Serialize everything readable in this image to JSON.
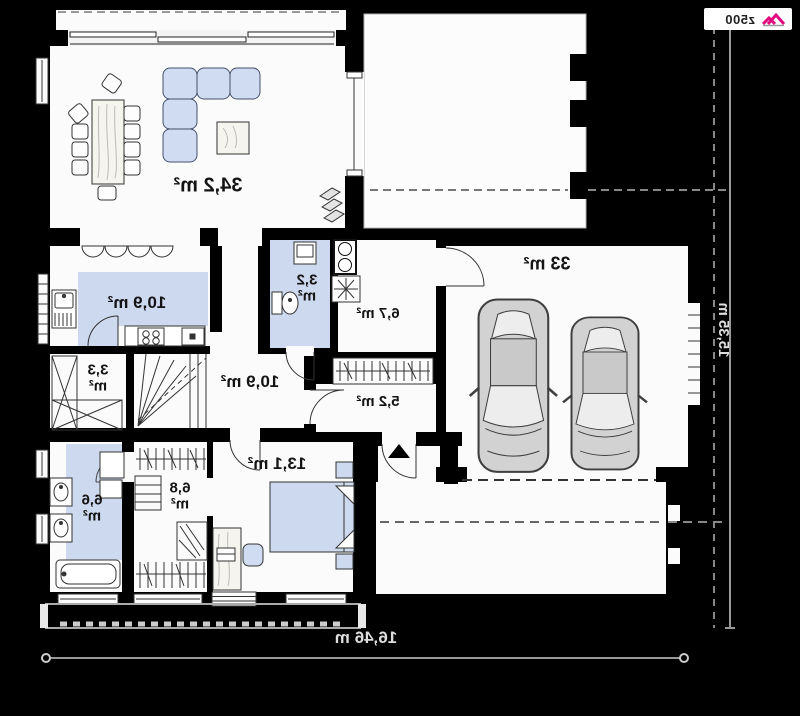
{
  "plan": {
    "rooms": {
      "living_room": "34,2 m²",
      "kitchen": "10,9 m²",
      "pantry": "3,3 m²",
      "bathroom": "6,6 m²",
      "wardrobe": "6,8 m²",
      "bedroom": "13,1 m²",
      "hall": "10,9 m²",
      "vestibule": "5,2 m²",
      "utility_room": "6,7 m²",
      "wc": "3,2 m²",
      "garage": "33 m²"
    },
    "dimensions": {
      "total_width": "16,46 m",
      "total_depth": "15,35 m"
    },
    "logo": {
      "brand": "z500"
    },
    "icons": {
      "entrance_marker": "black-triangle-arrow",
      "fireplace": "diamond-stack",
      "logo_roof": "pink-double-chevron"
    },
    "colors": {
      "background": "#000000",
      "floor": "#fbfbfb",
      "accent_blue": "#cdd9ee",
      "dimension_line": "#999999",
      "logo_pink": "#e5097f"
    }
  }
}
